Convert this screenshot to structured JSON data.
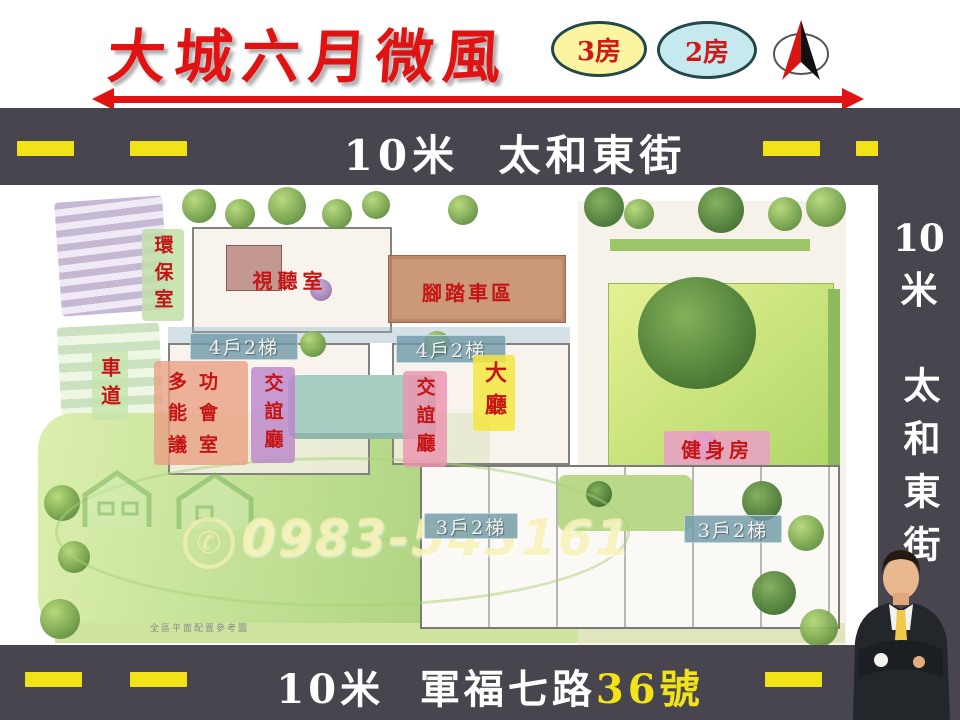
{
  "header": {
    "title": "大城六月微風",
    "badge_3room": "3房",
    "badge_2room": "2房"
  },
  "roads": {
    "top_street": "10米  太和東街",
    "bottom_street": "10米  軍福七路",
    "bottom_number": "36號",
    "right_width": "10",
    "right_meter": "米",
    "right_street": "太和東街"
  },
  "plan": {
    "label_recycle_room": "環保室",
    "label_av_room": "視聽室",
    "label_bike_area": "腳踏車區",
    "label_4units_left": "4戶2梯",
    "label_4units_right": "4戶2梯",
    "label_driveway": "車道",
    "label_meeting_room": "多功能會議室",
    "label_lounge_west": "交誼廳",
    "label_lounge_center": "交誼廳",
    "label_lobby": "大廳",
    "label_gym": "健身房",
    "label_3units_left": "3戶2梯",
    "label_3units_right": "3戶2梯",
    "caption": "全區平面配置參考圖",
    "watermark_phone": "0983-543161"
  },
  "colors": {
    "road_band": "#49454f",
    "lane_dash": "#f2e318",
    "title_red": "#e01212",
    "label_red": "#c41414",
    "badge_3room_fill": "#fbf4a0",
    "badge_2room_fill": "#c6e9f0"
  }
}
